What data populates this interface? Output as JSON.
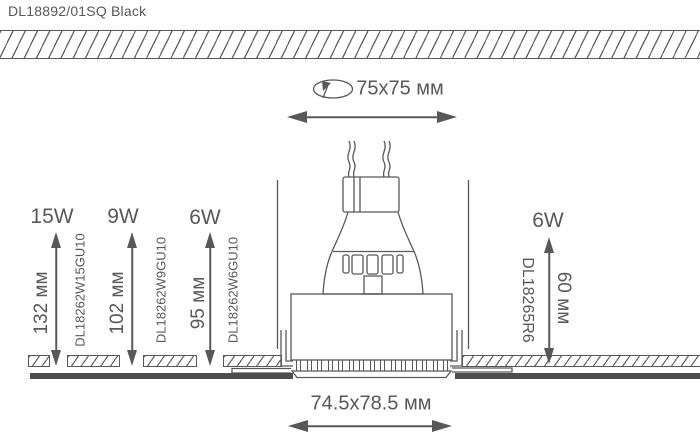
{
  "window": {
    "title": "DL18892/01SQ Black"
  },
  "colors": {
    "stroke": "#58585A",
    "dark_fill": "#4E4E50",
    "bg": "#FFFFFF"
  },
  "cutout": {
    "size_label": "75x75 мм",
    "icon": "rotate-icon"
  },
  "overall": {
    "size_label": "74.5x78.5 мм"
  },
  "gu10_lamps": [
    {
      "power": "15W",
      "height": "132 мм",
      "code": "DL18262W15GU10"
    },
    {
      "power": "9W",
      "height": "102 мм",
      "code": "DL18262W9GU10"
    },
    {
      "power": "6W",
      "height": "95 мм",
      "code": "DL18262W6GU10"
    }
  ],
  "led_module": {
    "power": "6W",
    "height": "60 мм",
    "code": "DL18265R6"
  }
}
